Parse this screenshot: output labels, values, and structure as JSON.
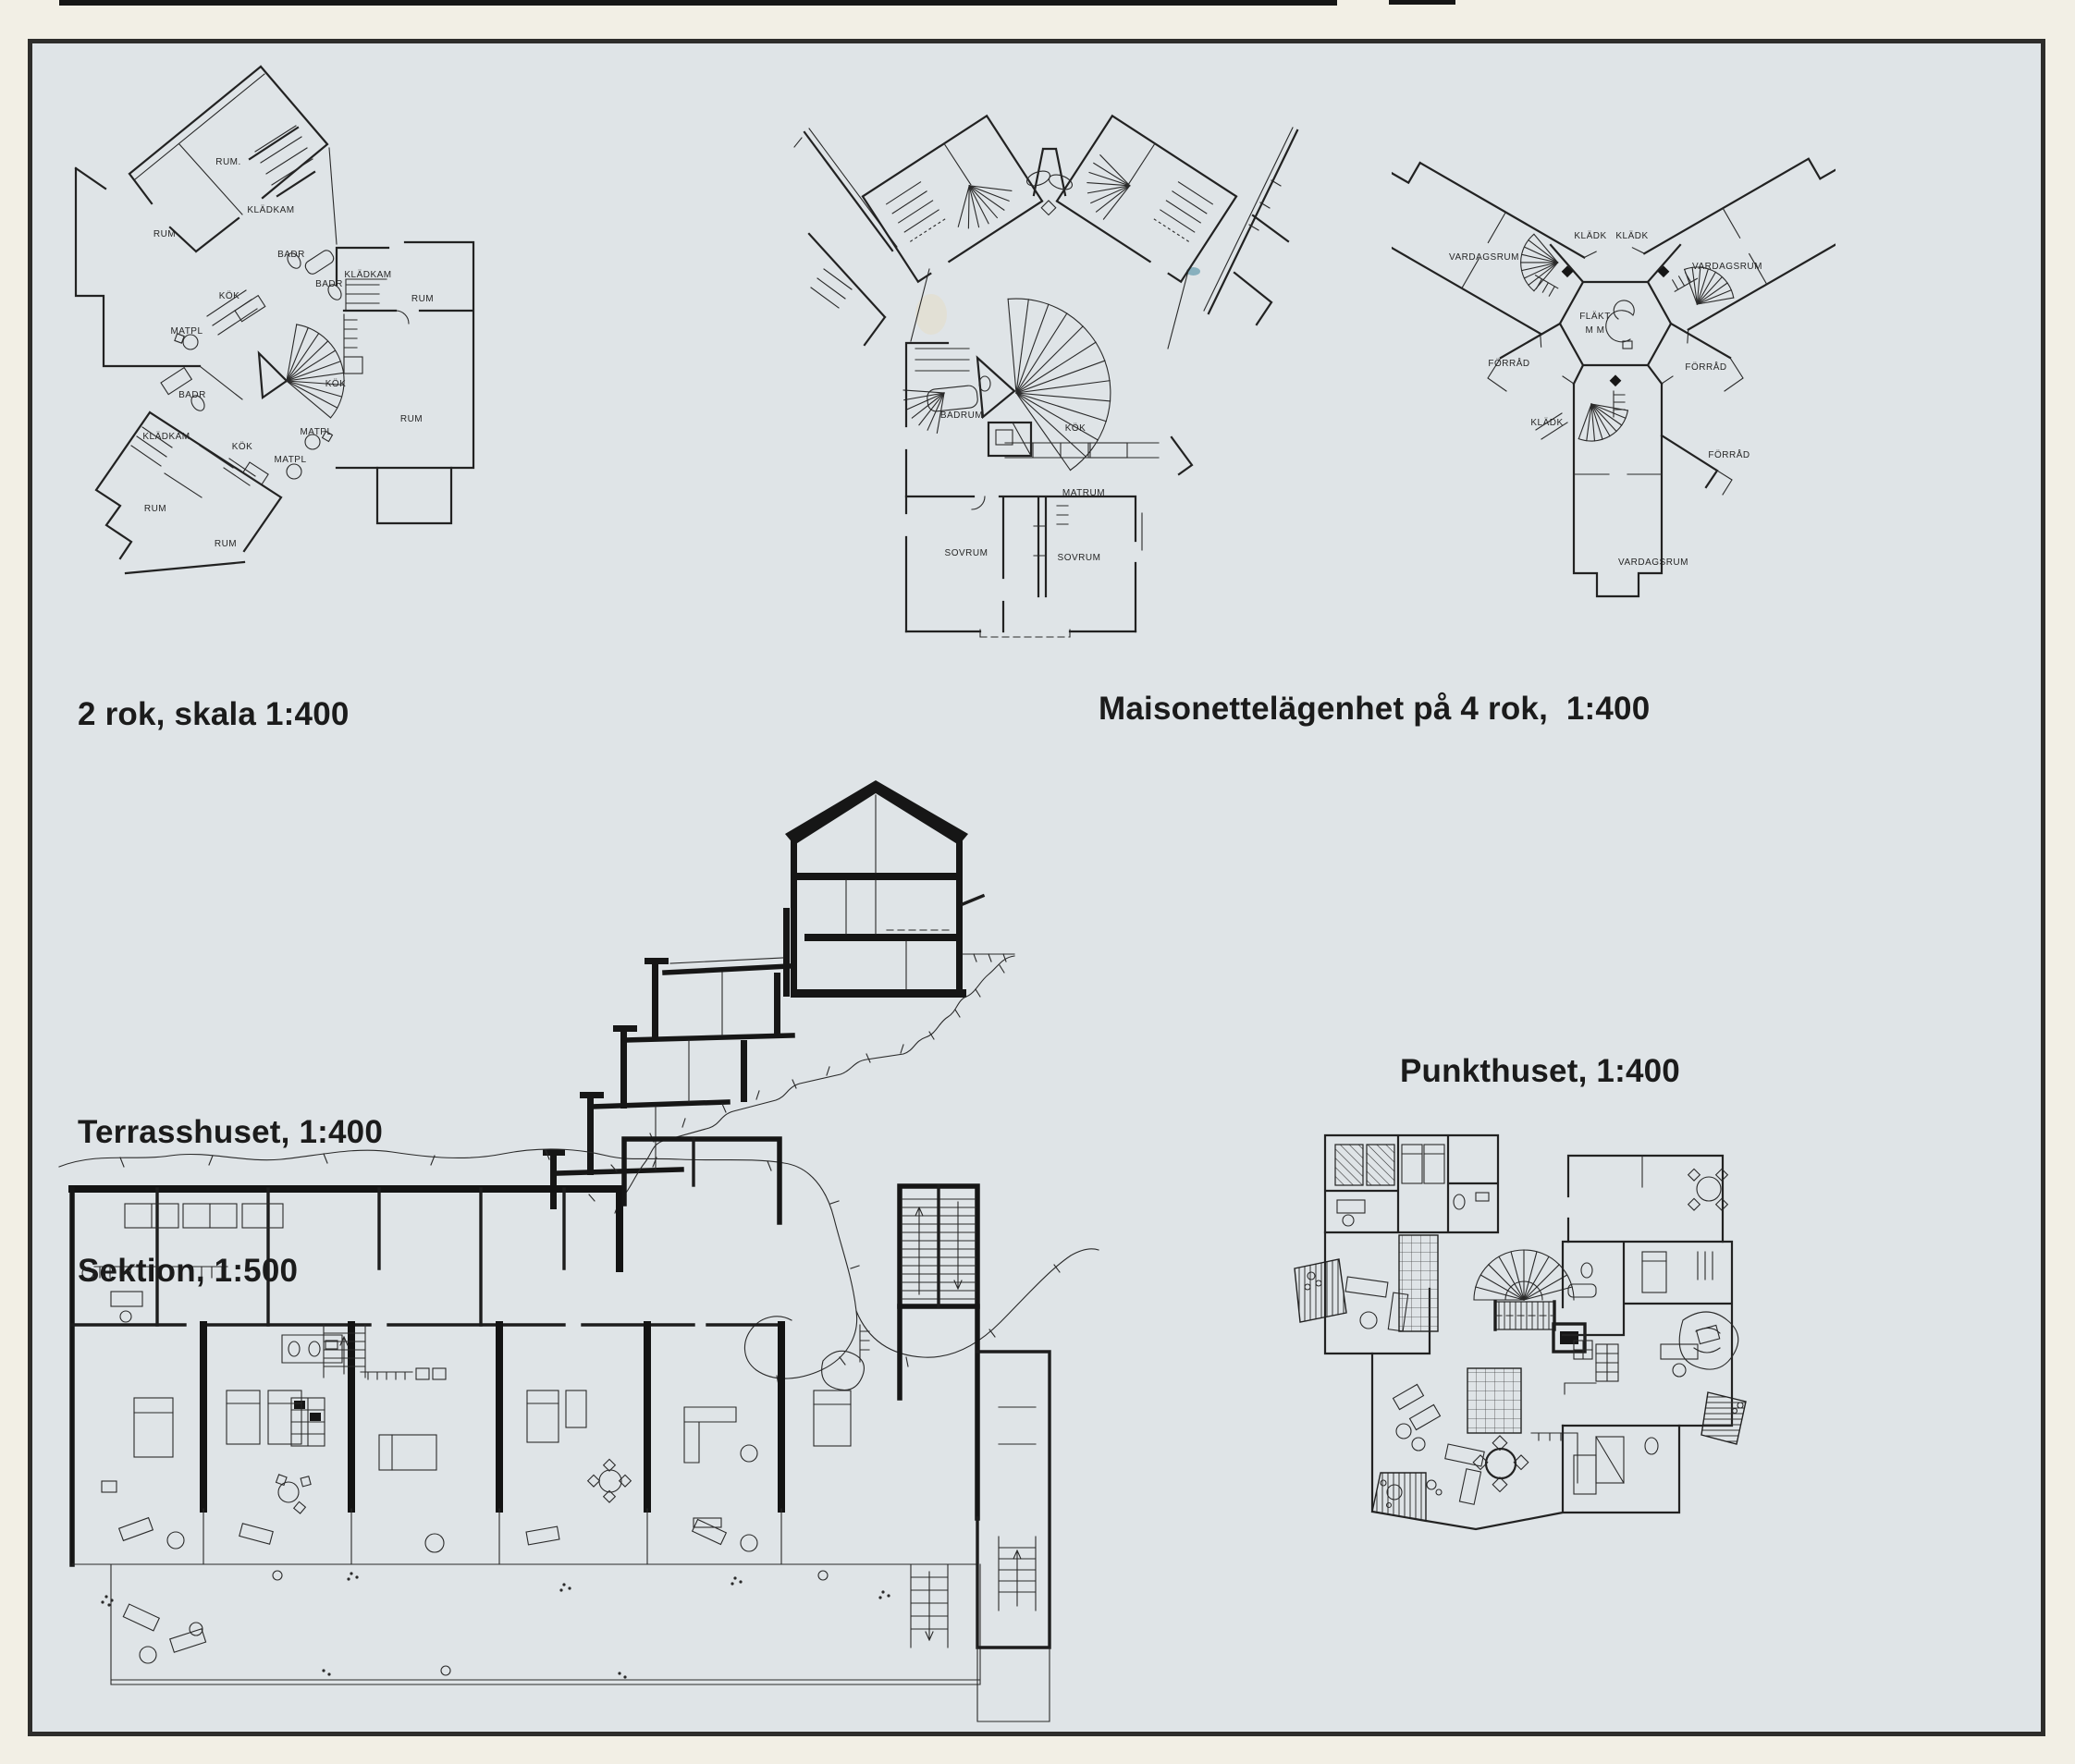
{
  "document": {
    "kind": "scanned architecture publication page",
    "language": "Swedish"
  },
  "colors": {
    "paper_outer": "#f2efe5",
    "paper_page": "#dfe4e7",
    "ink": "#1c1c1c"
  },
  "captions": {
    "c1": "2 rok, skala 1:400",
    "c2": "Maisonettelägenhet på 4 rok,  1:400",
    "c3a": "Terrasshuset, 1:400",
    "c3b": "Sektion, 1:500",
    "c4": "Punkthuset, 1:400"
  },
  "plans": {
    "two_rok": {
      "room_labels": [
        "RUM.",
        "RUM",
        "KLÄDKAM",
        "BADR",
        "BADR",
        "KLÄDKAM",
        "RUM",
        "KÖK",
        "MATPL",
        "KÖK",
        "RUM",
        "BADR",
        "KLÄDKAM",
        "MATPL",
        "KÖK",
        "MATPL",
        "RUM",
        "RUM"
      ]
    },
    "maisonette": {
      "room_labels": [
        "BADRUM",
        "KÖK",
        "MATRUM",
        "SOVRUM",
        "SOVRUM"
      ]
    },
    "y_plan": {
      "room_labels": [
        "VARDAGSRUM",
        "KLÄDK",
        "KLÄDK",
        "VARDAGSRUM",
        "FLÄKT",
        "M M",
        "FÖRRÅD",
        "FÖRRÅD",
        "KLÄDK",
        "FÖRRÅD",
        "VARDAGSRUM"
      ]
    }
  }
}
